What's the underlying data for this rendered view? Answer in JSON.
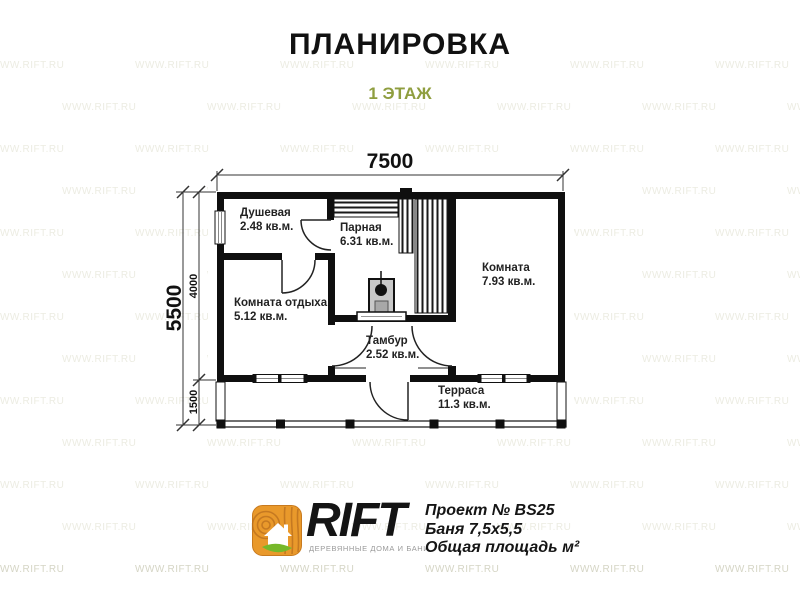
{
  "header": {
    "title": "ПЛАНИРОВКА",
    "subtitle": "1 ЭТАЖ",
    "subtitle_color": "#8f9e3f"
  },
  "watermark": {
    "text": "WWW.RIFT.RU",
    "color_light": "#ecece2",
    "color_bottom": "#d5d5c5"
  },
  "plan": {
    "dimensions": {
      "width_top": "7500",
      "height_left": "5500",
      "height_main": "4000",
      "height_terrace": "1500"
    },
    "rooms": [
      {
        "name": "Душевая",
        "area": "2.48 кв.м."
      },
      {
        "name": "Парная",
        "area": "6.31 кв.м."
      },
      {
        "name": "Комната",
        "area": "7.93 кв.м."
      },
      {
        "name": "Комната отдыха",
        "area": "5.12 кв.м."
      },
      {
        "name": "Тамбур",
        "area": "2.52 кв.м."
      },
      {
        "name": "Терраса",
        "area": "11.3 кв.м."
      }
    ]
  },
  "footer": {
    "brand": "RIFT",
    "brand_tagline": "ДЕРЕВЯННЫЕ ДОМА И БАНИ",
    "project_number": "Проект № BS25",
    "project_size": "Баня 7,5х5,5",
    "project_area": "Общая площадь м²",
    "logo_colors": {
      "wood": "#e9992b",
      "wood_dark": "#b96f1e",
      "leaf": "#76b82a",
      "house": "#ffffff"
    }
  }
}
